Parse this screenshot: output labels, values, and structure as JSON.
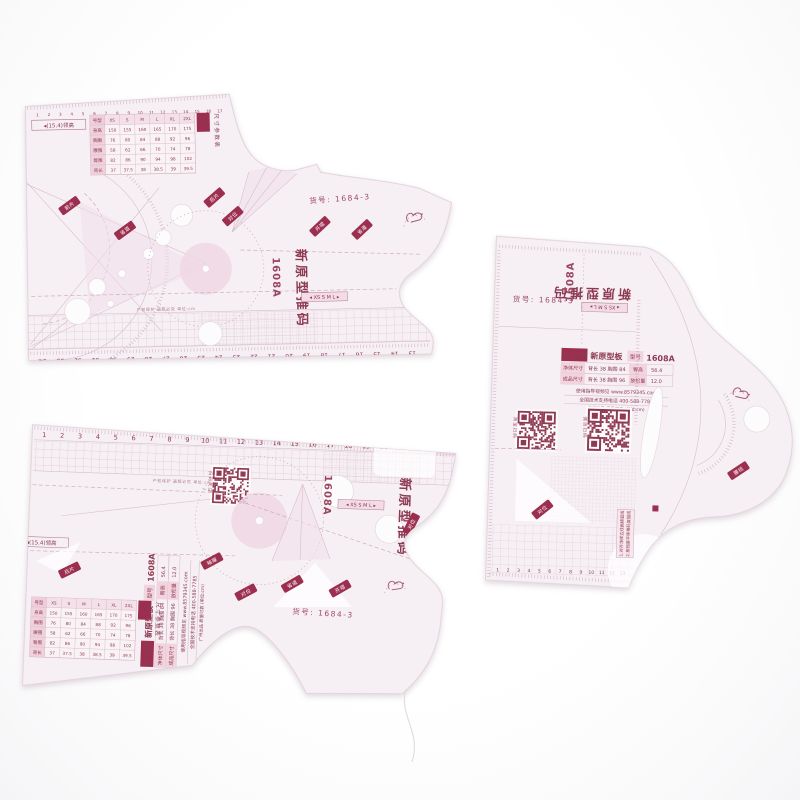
{
  "photo": {
    "colors": {
      "maroon": "#8e3a52",
      "label_red": "#9c2f4f",
      "pink_line": "#d9b3c3",
      "plastic": "#f6f0f5",
      "qr": "#8e3a52"
    },
    "item_no": "货号: 1684-3",
    "model": "1608A",
    "series_title": "新原型推码",
    "size_strip": "◂ XS S M L ▸",
    "neck_label": "◂(15.4)领高",
    "fine_print": "产权保护 盗版必究 单位:cm",
    "brand": "女上衣",
    "brand_sub": "新原型板",
    "model_label": "型号",
    "spec_rows": [
      {
        "k": "净体尺寸",
        "v": "背长 38 胸围 84",
        "k2": "臀高",
        "v2": "56.4"
      },
      {
        "k": "成品尺寸",
        "v": "背长 38 胸围 96",
        "k2": "放松量",
        "v2": "12.0"
      }
    ],
    "site_line": "使用指导视频见 www.8579345.com",
    "phone_line": "全国技术支持电话 400-588-7785",
    "origin_line": "广州出品 质量可靠 (单位:cm)",
    "qr_labels": [
      "淘宝扫码",
      "微信扫码",
      "扫码关注"
    ],
    "param_table": {
      "title": "尺寸参数表",
      "corner_tag": "袖片",
      "row_labels": [
        "号型",
        "身高",
        "胸围",
        "腰围",
        "臀围",
        "背长"
      ],
      "values": [
        [
          "XS",
          "S",
          "M",
          "L",
          "XL",
          "2XL"
        ],
        [
          "150",
          "155",
          "160",
          "165",
          "170",
          "175"
        ],
        [
          "76",
          "80",
          "84",
          "88",
          "92",
          "96"
        ],
        [
          "58",
          "62",
          "66",
          "70",
          "74",
          "78"
        ],
        [
          "82",
          "86",
          "90",
          "94",
          "98",
          "102"
        ],
        [
          "37",
          "37.5",
          "38",
          "38.5",
          "39",
          "39.5"
        ]
      ]
    },
    "instructions": [
      "1.对齐净样边线画顺弧线",
      "2.按档差平移推码复描线"
    ],
    "tags": [
      "前片",
      "后片",
      "袖片",
      "省道",
      "对位",
      "开褶",
      "肩线",
      "袖窿",
      "领口",
      "腰线",
      "扣位",
      "褶位"
    ],
    "rulers": {
      "a_top": [
        1,
        2,
        3,
        4,
        5,
        6,
        7,
        8,
        9,
        10,
        11,
        12,
        13,
        14,
        15,
        16,
        17
      ],
      "a_bottom": [
        34,
        33,
        32,
        31,
        30,
        29,
        28,
        27,
        26,
        25,
        24,
        23,
        22,
        21,
        20,
        19,
        18,
        17,
        16,
        15,
        14,
        13
      ],
      "b_top": [
        1,
        2,
        3,
        4,
        5,
        6,
        7,
        8,
        9,
        10,
        11,
        12,
        13,
        14,
        15,
        16,
        17,
        18,
        19,
        20,
        21,
        22,
        23
      ],
      "c_bottom": [
        1,
        2,
        3,
        4,
        5,
        6,
        7,
        8,
        9,
        10,
        11,
        12,
        13
      ]
    }
  }
}
